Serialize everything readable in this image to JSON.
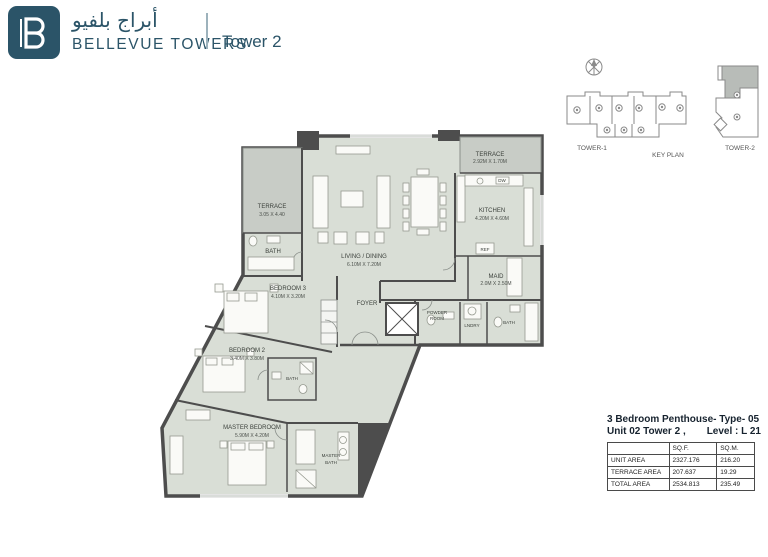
{
  "header": {
    "brand_arabic": "أبراج بلفيو",
    "brand_en": "BELLEVUE TOWERS",
    "tower": "Tower 2"
  },
  "key_plan": {
    "title": "KEY PLAN",
    "tower1_label": "TOWER-1",
    "tower2_label": "TOWER-2"
  },
  "floor_plan": {
    "rooms": {
      "terrace_left": {
        "name": "TERRACE",
        "dims": "3.05 X 4.40"
      },
      "terrace_top": {
        "name": "TERRACE",
        "dims": "2.92M X 1.70M"
      },
      "living": {
        "name": "LIVING / DINING",
        "dims": "6.10M X 7.20M"
      },
      "kitchen": {
        "name": "KITCHEN",
        "dims": "4.20M X 4.60M"
      },
      "maid": {
        "name": "MAID",
        "dims": "2.0M X 2.50M"
      },
      "foyer": {
        "name": "FOYER"
      },
      "powder_line1": {
        "name": "POWDER"
      },
      "powder_line2": {
        "name": "ROOM"
      },
      "laundry": {
        "name": "LNDRY"
      },
      "bath_service": {
        "name": "BATH"
      },
      "bath_upper": {
        "name": "BATH"
      },
      "bedroom3": {
        "name": "BEDROOM 3",
        "dims": "4.10M X 3.20M"
      },
      "bedroom2": {
        "name": "BEDROOM 2",
        "dims": "3.40M X 3.80M"
      },
      "bath_mid": {
        "name": "BATH"
      },
      "master": {
        "name": "MASTER BEDROOM",
        "dims": "5.90M X 4.20M"
      },
      "master_bath_1": {
        "name": "MASTER"
      },
      "master_bath_2": {
        "name": "BATH"
      }
    },
    "labels": {
      "ref": "REF",
      "dw": "DW"
    }
  },
  "unit_info": {
    "title": "3 Bedroom Penthouse- Type- 05",
    "subtitle_left": "Unit 02 Tower 2 ,",
    "subtitle_right": "Level : L 21",
    "table": {
      "headers": [
        "",
        "SQ.F.",
        "SQ.M."
      ],
      "rows": [
        {
          "label": "UNIT AREA",
          "sqf": "2327.176",
          "sqm": "216.20"
        },
        {
          "label": "TERRACE AREA",
          "sqf": "207.637",
          "sqm": "19.29"
        },
        {
          "label": "TOTAL AREA",
          "sqf": "2534.813",
          "sqm": "235.49"
        }
      ]
    }
  },
  "colors": {
    "brand_teal": "#2b5468",
    "room_fill": "#d9ded6",
    "terrace_fill": "#c8ccc6",
    "wall": "#4d4d4d"
  }
}
